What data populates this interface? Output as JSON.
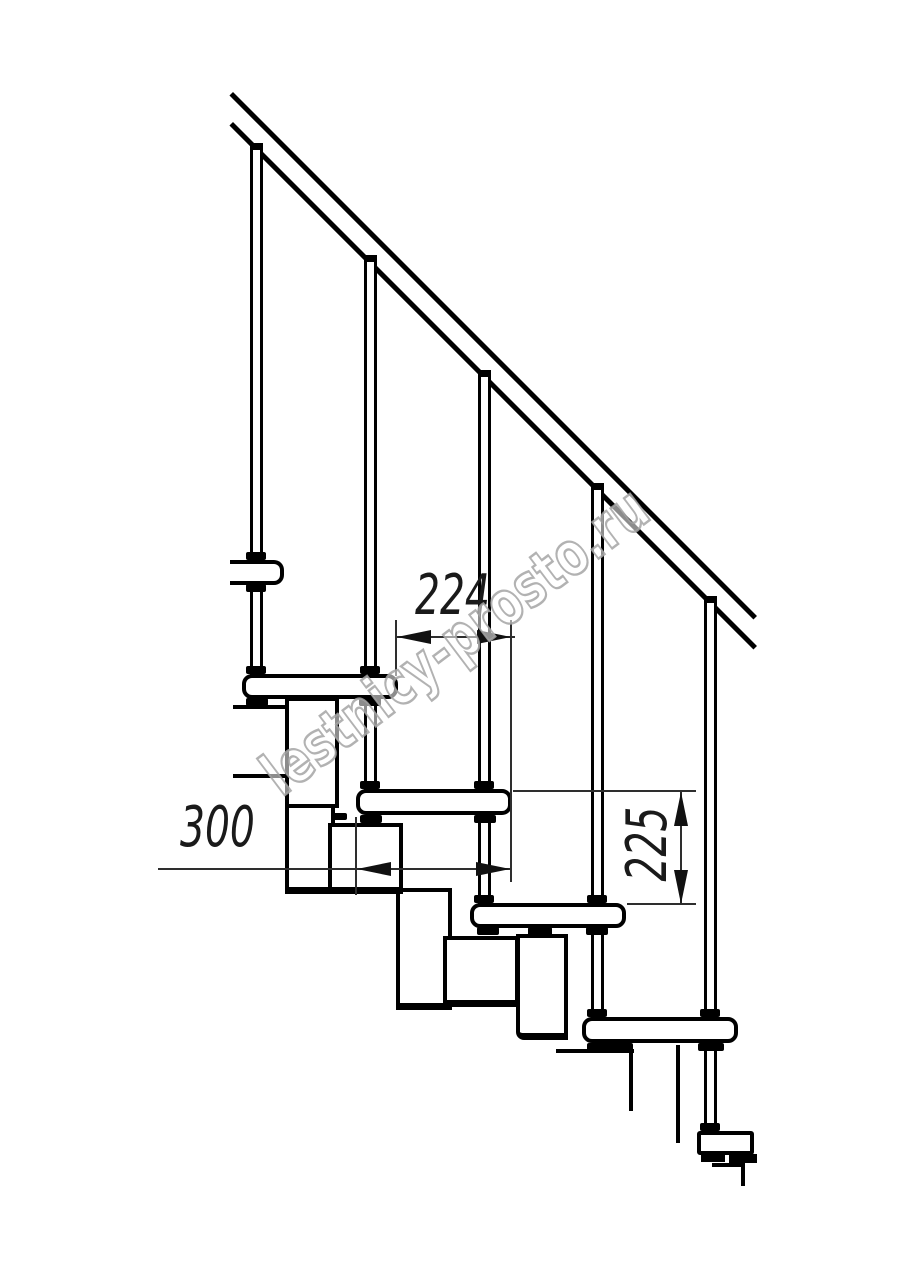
{
  "drawing": {
    "kind": "modular staircase side-view fragment",
    "background_color": "#ffffff",
    "line_color": "#000000",
    "dimension_line_color": "#2e2e2e"
  },
  "dimensions": {
    "run_label": "224",
    "depth_label": "300",
    "rise_label": "225"
  },
  "watermark": {
    "text": "lestnicy-prosto.ru",
    "color": "#a5a5a5"
  }
}
